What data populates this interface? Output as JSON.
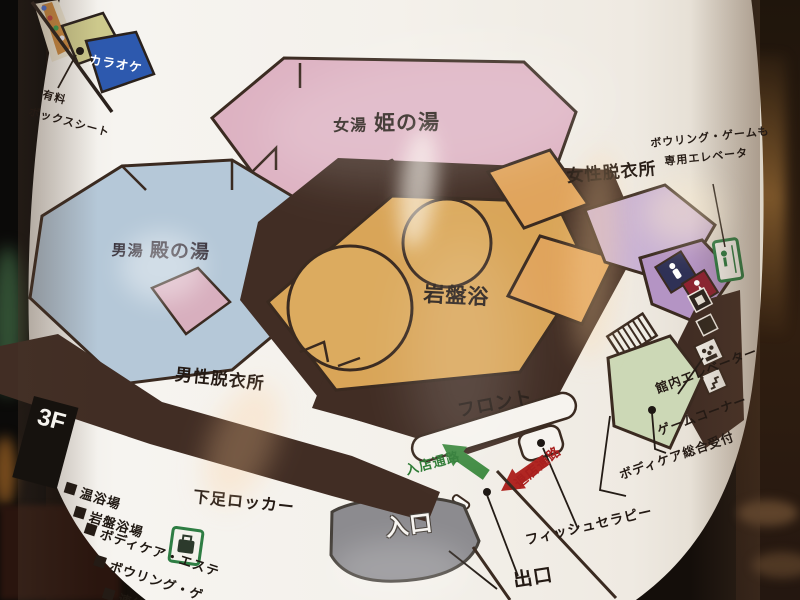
{
  "map": {
    "floor_badge": "3F",
    "labels": {
      "karaoke": "カラオケ",
      "paid_box_seat_line1": "有料",
      "paid_box_seat_line2": "ボックスシート",
      "womens_bath_prefix": "女湯",
      "womens_bath_name": "姫の湯",
      "mens_bath_prefix": "男湯",
      "mens_bath_name": "殿の湯",
      "womens_dressing_room": "女性脱衣所",
      "mens_dressing_room": "男性脱衣所",
      "stone_sauna": "岩盤浴",
      "bowling_elevator_note_line1": "ボウリング・ゲームも",
      "bowling_elevator_note_line2": "専用エレベータ",
      "front_desk": "フロント",
      "entry_passage": "入店通路",
      "exit_passage": "退店通路",
      "shoe_locker": "下足ロッカー",
      "entrance": "入口",
      "exit": "出口",
      "fish_therapy": "フィッシュセラピー",
      "bodycare_reception": "ボディケア総合受付",
      "game_corner": "ゲームコーナー",
      "building_elevator": "館内エレベーター"
    },
    "legend": [
      "温浴場",
      "岩盤浴場",
      "ボディケア・エステ",
      "ボウリング・ゲ",
      "連絡エ"
    ],
    "colors": {
      "womens_bath_pink": "#ddb2c2",
      "mens_bath_blue": "#b5c8d8",
      "stone_sauna_tan": "#d9a558",
      "wall_brown": "#412d24",
      "dressing_lilac": "#c9b2d4",
      "orange_room": "#e0a45c",
      "game_zone_green": "#ccd8b6",
      "karaoke_blue": "#2d59ae",
      "entry_arrow_green": "#3e8a40",
      "exit_arrow_red": "#b02622",
      "entrance_gray": "#8c8b8f"
    }
  }
}
